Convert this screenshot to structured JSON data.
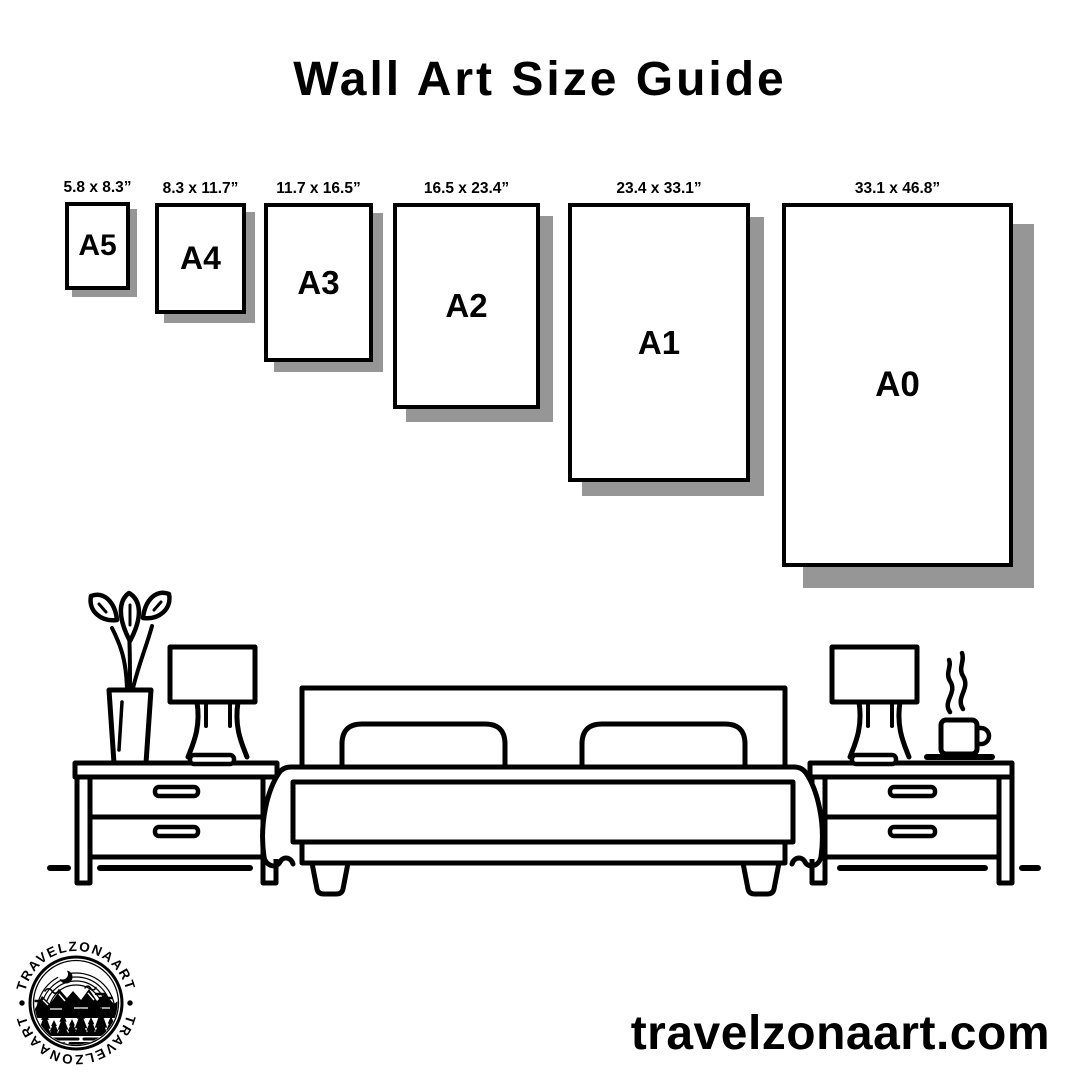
{
  "title": "Wall Art Size Guide",
  "posters": [
    {
      "code": "A5",
      "dims": "5.8 x 8.3”"
    },
    {
      "code": "A4",
      "dims": "8.3 x 11.7”"
    },
    {
      "code": "A3",
      "dims": "11.7 x 16.5”"
    },
    {
      "code": "A2",
      "dims": "16.5 x 23.4”"
    },
    {
      "code": "A1",
      "dims": "23.4 x 33.1”"
    },
    {
      "code": "A0",
      "dims": "33.1 x 46.8”"
    }
  ],
  "illustration": {
    "scene": "bedroom-line-art",
    "items": [
      "potted-plant",
      "table-lamp-left",
      "nightstand-left",
      "double-bed-with-pillows",
      "table-lamp-right",
      "coffee-cup-with-steam",
      "nightstand-right",
      "floor-line"
    ]
  },
  "logo": {
    "arc_text_top": "TRAVELZONAART",
    "arc_text_bottom": "TRAVELZONAART",
    "emblem": "mountains-pines-moon-lake"
  },
  "footer": {
    "website": "travelzonaart.com"
  },
  "colors": {
    "ink": "#000000",
    "background": "#ffffff",
    "poster_shadow": "#969696"
  }
}
